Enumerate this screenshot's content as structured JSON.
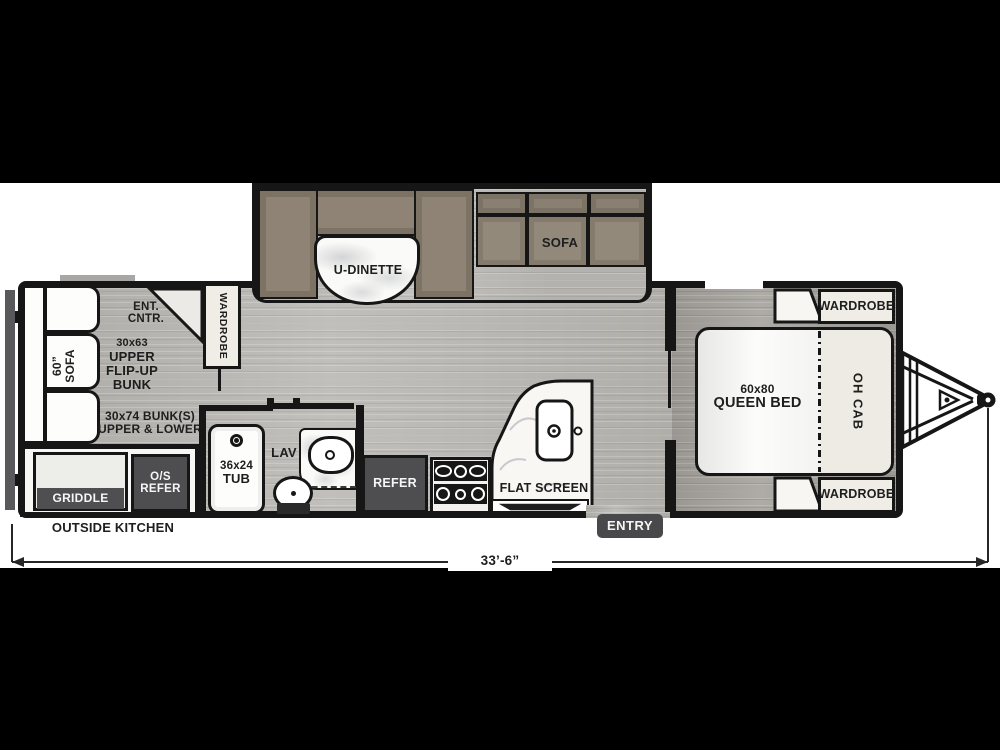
{
  "slideout": {
    "dinette": "U-DINETTE",
    "sofa": "SOFA"
  },
  "left_section": {
    "sofa_size": "60”",
    "sofa": "SOFA",
    "ent1": "ENT.",
    "ent2": "CNTR.",
    "wardrobe": "WARDROBE",
    "bunk_upper": [
      "30x63",
      "UPPER",
      "FLIP-UP",
      "BUNK"
    ],
    "bunk_lower": [
      "30x74 BUNK(S)",
      "UPPER & LOWER"
    ]
  },
  "outside_kitchen": {
    "griddle": "GRIDDLE",
    "os1": "O/S",
    "os2": "REFER",
    "caption": "OUTSIDE KITCHEN"
  },
  "bathroom": {
    "tub1": "36x24",
    "tub2": "TUB",
    "lav": "LAV"
  },
  "kitchen": {
    "refer": "REFER",
    "flat_screen": "FLAT SCREEN"
  },
  "entry": {
    "label": "ENTRY"
  },
  "bedroom": {
    "bed1": "60x80",
    "bed2": "QUEEN BED",
    "wardrobe_top": "WARDROBE",
    "wardrobe_bottom": "WARDROBE",
    "oh_cab": "OH CAB"
  },
  "dimension": {
    "length": "33’-6”"
  },
  "colors": {
    "wall": "#161616",
    "floor": "#b8b6b2",
    "bedroom_floor": "#a5a29d",
    "cushion_taupe": "#93897a",
    "dark_appliance": "#4e4e50",
    "cabinet_cream": "#efede6",
    "marble": "#fafaf8"
  }
}
